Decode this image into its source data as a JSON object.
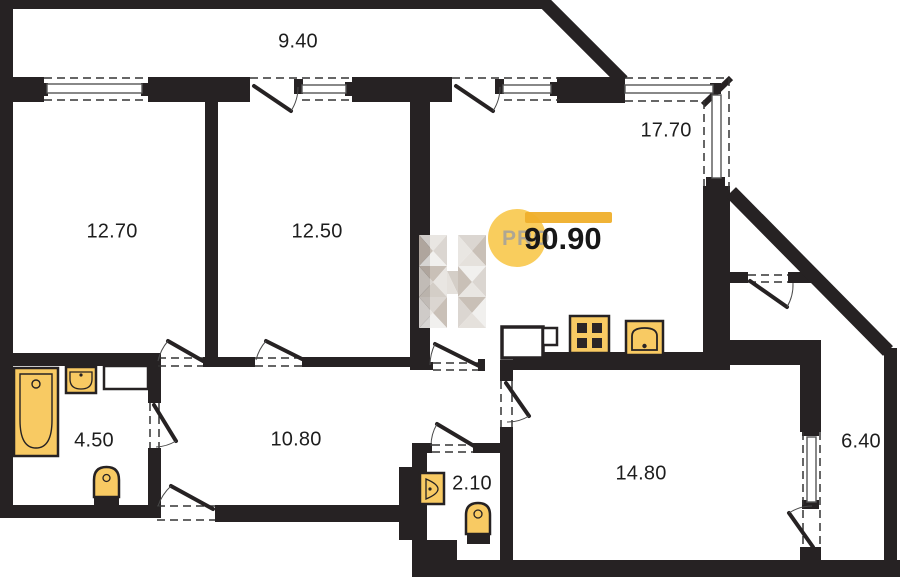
{
  "plan": {
    "total_area": "90.90",
    "watermark": {
      "pro": "PRO",
      "letter": "H"
    },
    "rooms": [
      {
        "name": "balcony-top",
        "area": "9.40"
      },
      {
        "name": "bedroom-1",
        "area": "12.70"
      },
      {
        "name": "bedroom-2",
        "area": "12.50"
      },
      {
        "name": "living-room",
        "area": "17.70"
      },
      {
        "name": "bathroom",
        "area": "4.50"
      },
      {
        "name": "hallway",
        "area": "10.80"
      },
      {
        "name": "wc",
        "area": "2.10"
      },
      {
        "name": "kitchen",
        "area": "14.80"
      },
      {
        "name": "balcony-right",
        "area": "6.40"
      }
    ],
    "fixtures": [
      "bathtub",
      "bathroom-sink",
      "bathroom-toilet",
      "wc-sink",
      "wc-toilet",
      "stove",
      "kitchen-sink"
    ],
    "colors": {
      "wall": "#262223",
      "fixture_fill": "#F8CA63",
      "accent_circle": "#F8C84B",
      "accent_bar": "#EFAF2B",
      "watermark_gray": "#a6a29b"
    }
  }
}
